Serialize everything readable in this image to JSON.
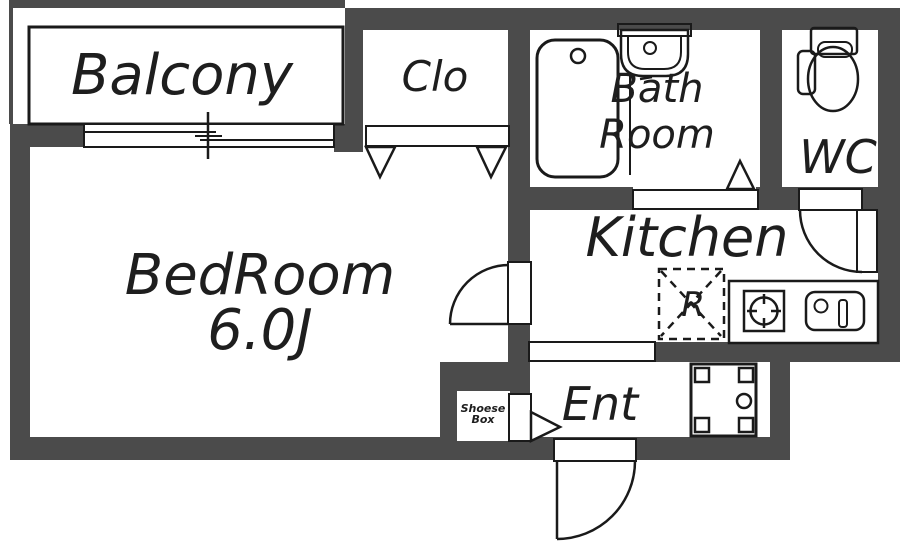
{
  "rooms": {
    "balcony": {
      "label": "Balcony"
    },
    "closet": {
      "label": "Clo"
    },
    "bathroom": {
      "line1": "Bath",
      "line2": "Room"
    },
    "wc": {
      "label": "WC"
    },
    "bedroom": {
      "name": "BedRoom",
      "size": "6.0J"
    },
    "kitchen": {
      "label": "Kitchen"
    },
    "entrance": {
      "label": "Ent"
    }
  },
  "fixtures": {
    "refrigerator": {
      "label": "R"
    },
    "shoe_box": {
      "line1": "Shoese",
      "line2": "Box"
    }
  },
  "colors": {
    "wall": "#4b4b4b",
    "line": "#1a1a1a",
    "floor": "#ffffff",
    "text": "#1e1e1e"
  }
}
